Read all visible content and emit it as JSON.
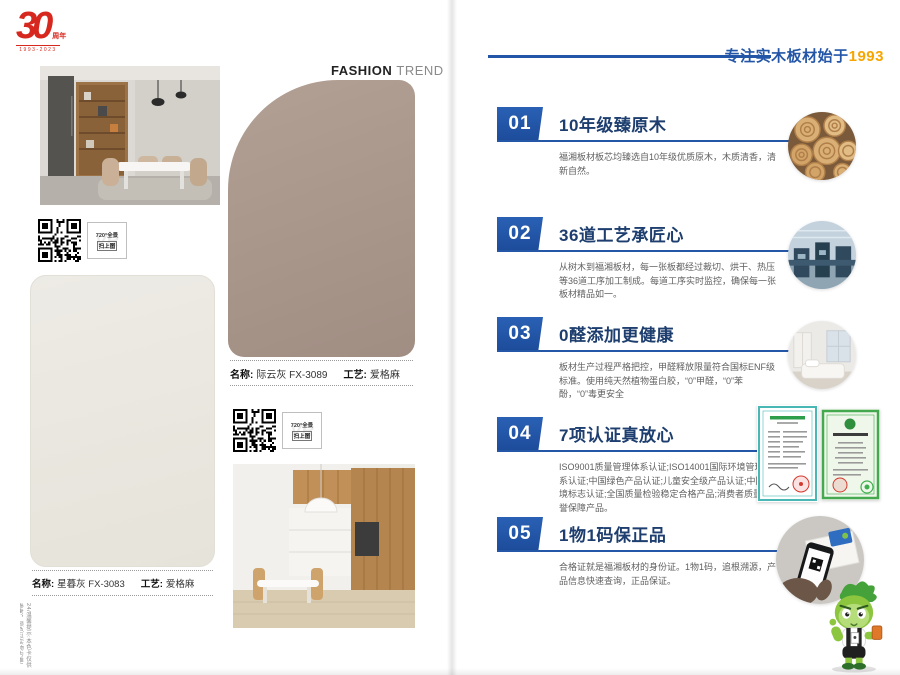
{
  "left_page": {
    "logo": {
      "number": "30",
      "suffix": "周年",
      "years": "1993-2023"
    },
    "fashion_trend": {
      "bold": "FASHION",
      "light": "TREND"
    },
    "qr_tag": {
      "line1": "720°全景",
      "line2": "扫上图",
      "watermark": "VR"
    },
    "swatches": [
      {
        "name_label": "名称:",
        "name": "际云灰 FX-3089",
        "craft_label": "工艺:",
        "craft": "爱格麻",
        "color": "#a8948a"
      },
      {
        "name_label": "名称:",
        "name": "星暮灰 FX-3083",
        "craft_label": "工艺:",
        "craft": "爱格麻",
        "color": "#ebe8e1"
      }
    ],
    "photos": [
      "dining-room-photo",
      "kitchen-photo"
    ],
    "footnote": "24/温馨提示:本色卡仅供参考，颜色以实物为准!"
  },
  "right_page": {
    "slogan": {
      "text": "专注实木板材始于",
      "year": "1993"
    },
    "accent_blue": "#2356a7",
    "accent_orange": "#f7a600",
    "items": [
      {
        "num": "01",
        "title": "10年级臻原木",
        "desc": "福湘板材板芯均臻选自10年级优质原木，木质清香，清新自然。",
        "media": "wood-logs-photo"
      },
      {
        "num": "02",
        "title": "36道工艺承匠心",
        "desc": "从树木到福湘板材，每一张板都经过裁切、烘干、热压等36道工序加工制成。每道工序实时监控，确保每一张板材精品如一。",
        "media": "factory-photo"
      },
      {
        "num": "03",
        "title": "0醛添加更健康",
        "desc": "板材生产过程严格把控，甲醛释放限量符合国标ENF级标准。使用纯天然植物蛋白胶，“0”甲醛，“0”苯酚，“0”毒更安全",
        "media": "interior-photo"
      },
      {
        "num": "04",
        "title": "7项认证真放心",
        "desc": "ISO9001质量管理体系认证;ISO14001国际环境管理体系认证;中国绿色产品认证;儿童安全级产品认证;中国环境标志认证;全国质量检验稳定合格产品;消费者质量信誉保障产品。",
        "media": "certificates-photo"
      },
      {
        "num": "05",
        "title": "1物1码保正品",
        "desc": "合格证就是福湘板材的身份证。1物1码，追根溯源，产品信息快速查询，正品保证。",
        "media": "qr-scan-photo"
      }
    ],
    "mascot": "green-mascot"
  }
}
